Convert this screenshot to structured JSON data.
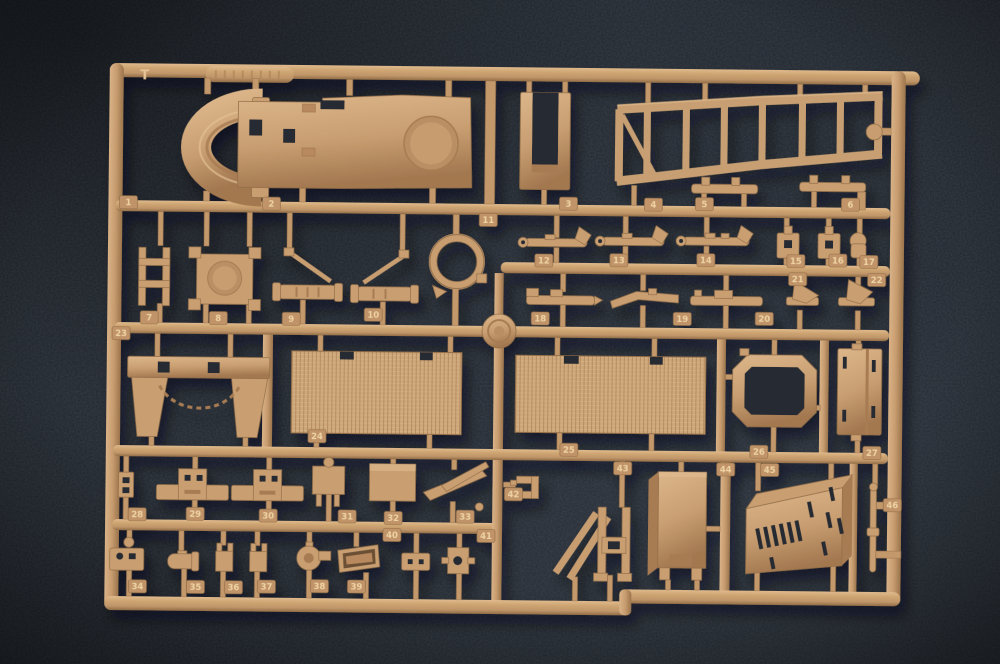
{
  "scene": {
    "subject": "Photograph of a tan injection-molded plastic model kit sprue (parts tree) lying on a dark blue-gray fabric background",
    "sprue_letter": "T",
    "part_count": 46,
    "colors": {
      "plastic": "#C89E71",
      "plastic_highlight": "#E3BF92",
      "plastic_shadow": "#8F6A45",
      "background": "#222831",
      "tag_text": "#EED2A4"
    }
  },
  "part_numbers": [
    "1",
    "2",
    "3",
    "4",
    "5",
    "6",
    "7",
    "8",
    "9",
    "10",
    "11",
    "12",
    "13",
    "14",
    "15",
    "16",
    "17",
    "18",
    "19",
    "20",
    "21",
    "22",
    "23",
    "24",
    "25",
    "26",
    "27",
    "28",
    "29",
    "30",
    "31",
    "32",
    "33",
    "34",
    "35",
    "36",
    "37",
    "38",
    "39",
    "40",
    "41",
    "42",
    "43",
    "44",
    "45",
    "46"
  ]
}
